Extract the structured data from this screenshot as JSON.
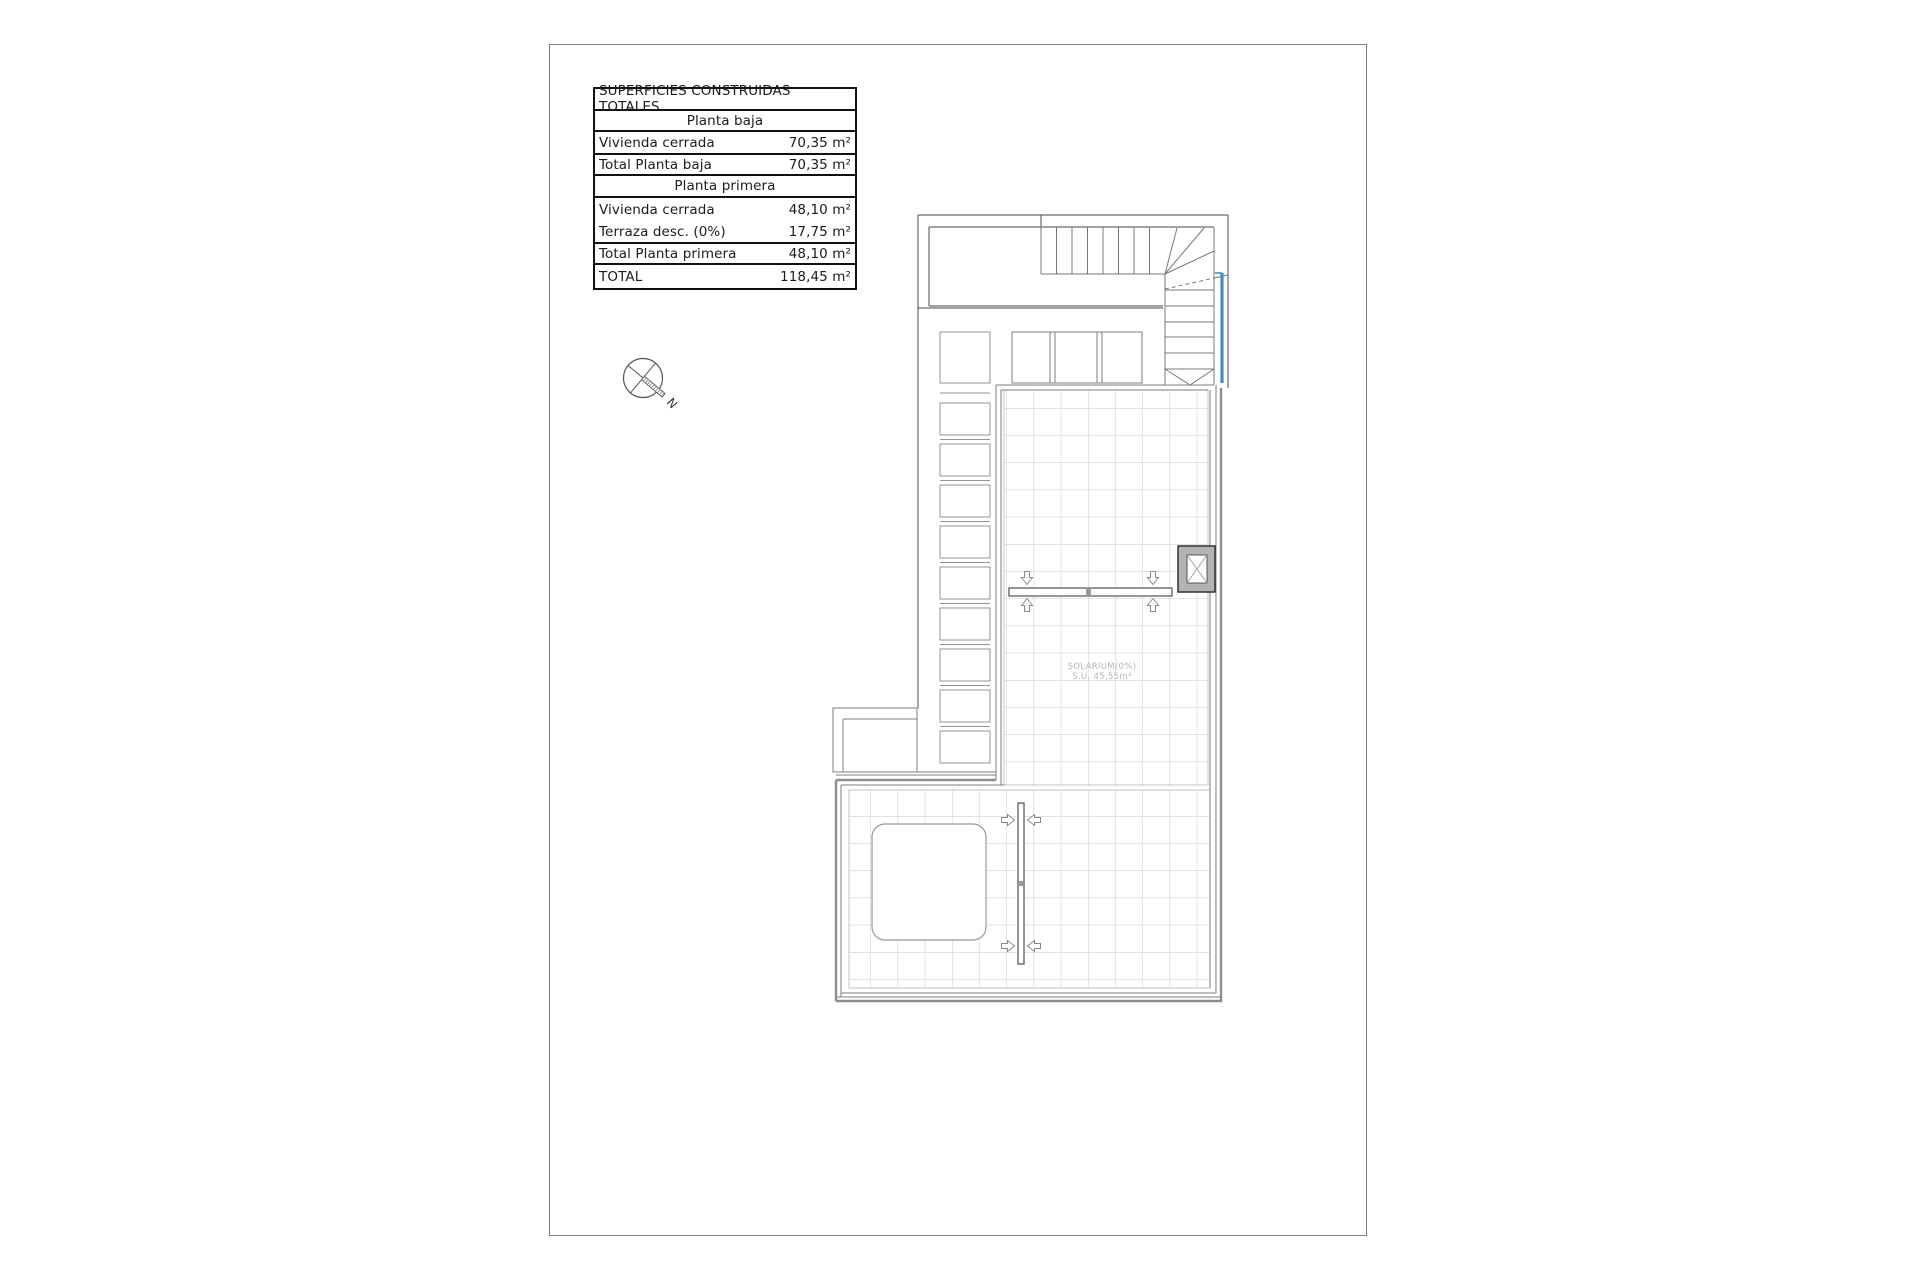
{
  "area_table": {
    "title": "SUPERFICIES CONSTRUIDAS TOTALES",
    "rows": [
      {
        "type": "section",
        "label": "Planta baja"
      },
      {
        "type": "data",
        "label": "Vivienda cerrada",
        "value": "70,35 m²"
      },
      {
        "type": "data",
        "label": "Total Planta baja",
        "value": "70,35 m²"
      },
      {
        "type": "section",
        "label": "Planta primera"
      },
      {
        "type": "data2",
        "label": "Vivienda cerrada",
        "value": "48,10 m²",
        "label2": "Terraza desc. (0%)",
        "value2": "17,75 m²"
      },
      {
        "type": "data",
        "label": "Total Planta primera",
        "value": "48,10 m²"
      },
      {
        "type": "data",
        "label": "TOTAL",
        "value": "118,45 m²"
      }
    ]
  },
  "plan": {
    "solarium_label_line1": "SOLARIUM(0%)",
    "solarium_label_line2": "S.U. 45,55m²",
    "compass_label": "N",
    "accent_blue": "#3f8fc6"
  }
}
